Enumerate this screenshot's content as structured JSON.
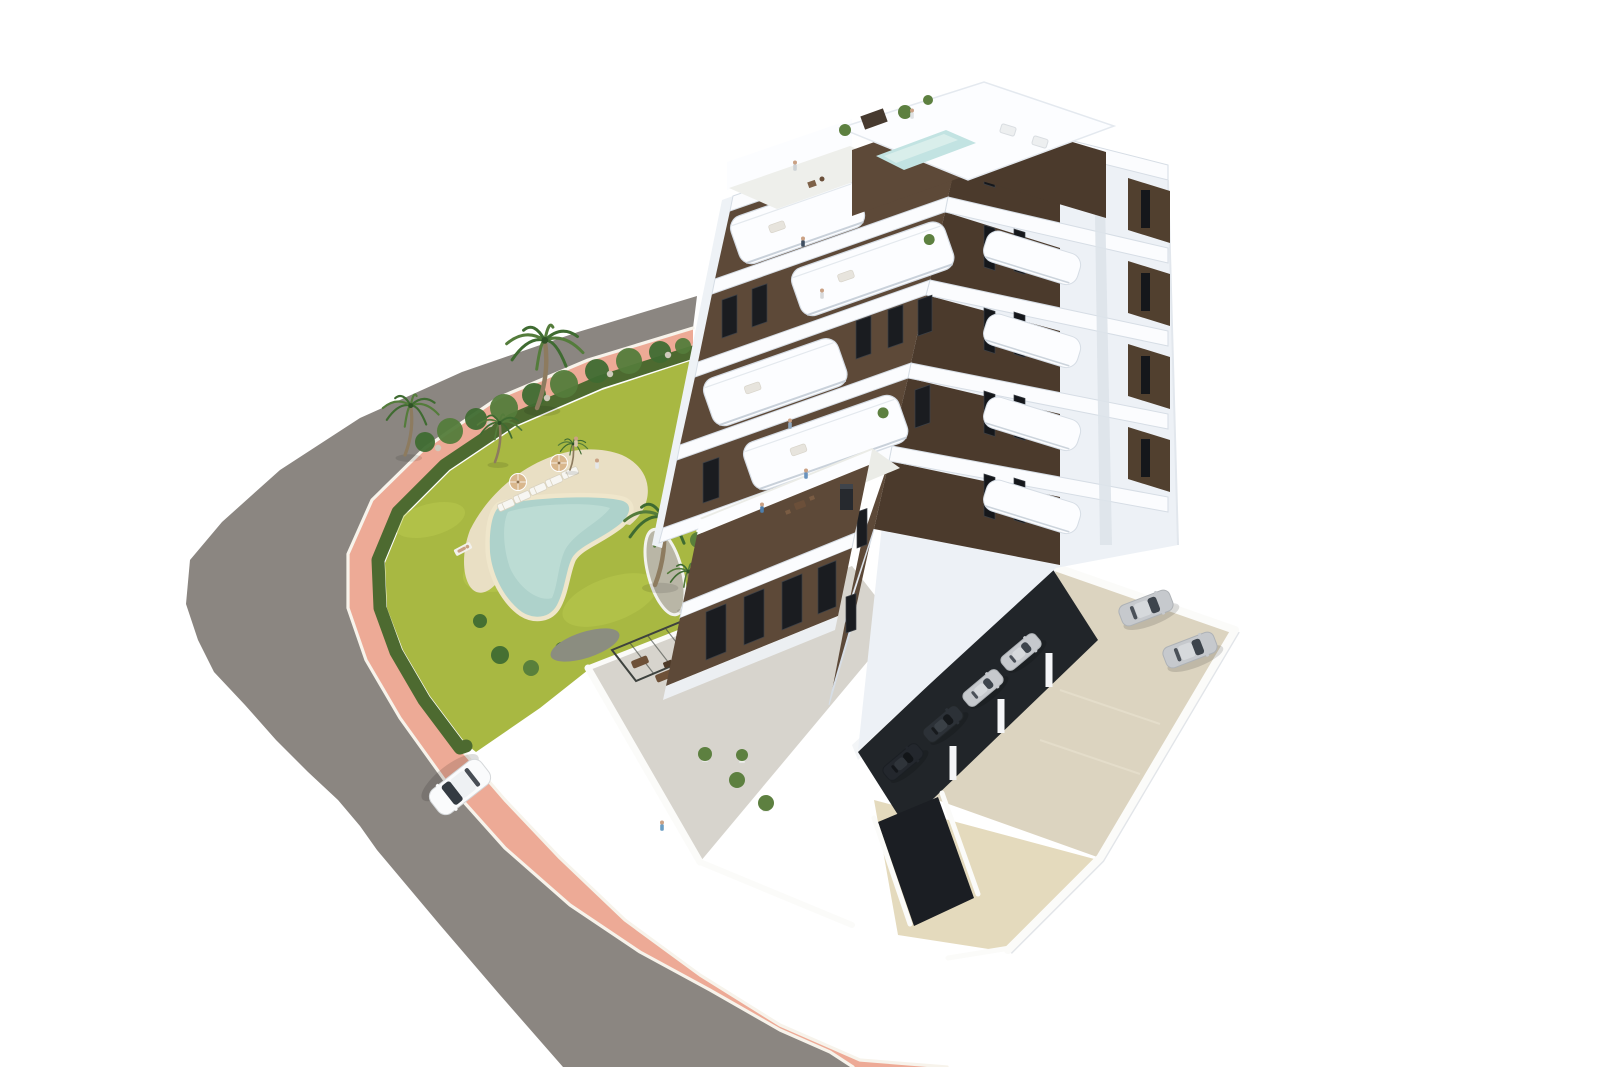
{
  "meta": {
    "title": "Aerial 3D architectural render - modern seaside apartment residence",
    "description": "Aerial 3D architectural rendering of a modern eight-storey white apartment tower with dark-brown facade panels, rounded white balconies, rooftop terraces with a small plunge pool, a landscaped garden with a free-form swimming pool, sun loungers, parasols and palm trees, a curved grey asphalt road with a salmon-pink promenade sidewalk, a white car driving on the road, and a walled parking area with parked cars.",
    "background": "#ffffff"
  },
  "colors": {
    "background": "#ffffff",
    "road": "#8b8681",
    "road_dark": "#7e7974",
    "sidewalk_pink": "#edaa96",
    "sidewalk_pink_light": "#f3bfae",
    "curb": "#f7f3eb",
    "hedge": "#4d6a30",
    "grass": "#a8b842",
    "grass_light": "#bac94e",
    "grass_shadow": "#8aa03a",
    "sand": "#e9dfc4",
    "pool_water": "#aed2cb",
    "pool_water_light": "#c9e3dc",
    "pool_coping": "#efe6cb",
    "building_white": "#fcfdff",
    "slab_white": "#fbfcfe",
    "slab_stroke": "#d6dde5",
    "face_shade": "#edf1f6",
    "face_shade_dark": "#dde3ea",
    "facade_brown": "#5d4938",
    "facade_brown_dark": "#4b3a2c",
    "window_dark": "#1a1c20",
    "terrace_concrete": "#d7d4cd",
    "parking_ground": "#dcd4c0",
    "driveway_beige": "#e4dabd",
    "garage_dark": "#212529",
    "wall_white": "#fbfbf9",
    "rooftop_pool": "#c2e3e2",
    "palm_green": "#3f6b31",
    "palm_green2": "#547c3b",
    "palm_trunk": "#8d7b5f",
    "plant_green": "#5d8040",
    "rock_gray": "#b9b6a6",
    "umbrella_tan": "#d9b78d",
    "car_white": "#fafbfc",
    "car_silver": "#c6c9cd",
    "car_dark": "#2c3137",
    "car_glass": "#343b42",
    "skin": "#caa184"
  },
  "counts": {
    "building_floors_visible": 8,
    "palm_trees": 6,
    "sun_loungers": 5,
    "parasols": 2,
    "people_visible": 11,
    "cars_on_road": 1,
    "cars_in_open_parking": 2,
    "cars_under_building": 4
  },
  "palms": [
    [
      405,
      455,
      0.95
    ],
    [
      537,
      408,
      1.3
    ],
    [
      495,
      462,
      0.75
    ],
    [
      570,
      470,
      0.5
    ],
    [
      655,
      585,
      1.3
    ],
    [
      684,
      608,
      0.7
    ]
  ],
  "bushes": [
    [
      425,
      442,
      10
    ],
    [
      450,
      431,
      13
    ],
    [
      476,
      419,
      11
    ],
    [
      504,
      408,
      14
    ],
    [
      534,
      395,
      12
    ],
    [
      564,
      384,
      14
    ],
    [
      597,
      371,
      12
    ],
    [
      629,
      361,
      13
    ],
    [
      660,
      352,
      11
    ],
    [
      683,
      346,
      8
    ],
    [
      500,
      655,
      9
    ],
    [
      531,
      668,
      8
    ],
    [
      562,
      649,
      7
    ],
    [
      601,
      641,
      8
    ],
    [
      480,
      621,
      7
    ],
    [
      700,
      470,
      8
    ],
    [
      706,
      502,
      7
    ],
    [
      698,
      540,
      8
    ]
  ],
  "rocks": [
    [
      438,
      448
    ],
    [
      490,
      424
    ],
    [
      547,
      398
    ],
    [
      610,
      374
    ],
    [
      668,
      355
    ],
    [
      672,
      590
    ],
    [
      690,
      602
    ],
    [
      660,
      600
    ],
    [
      600,
      648
    ],
    [
      575,
      640
    ]
  ],
  "grass_patches": [
    [
      520,
      560,
      60,
      26,
      -20
    ],
    [
      610,
      600,
      50,
      22,
      -20
    ],
    [
      430,
      520,
      36,
      16,
      -15
    ]
  ],
  "loungers": [
    [
      506,
      505,
      -24
    ],
    [
      522,
      497,
      -24
    ],
    [
      538,
      489,
      -24
    ],
    [
      554,
      481,
      -24
    ],
    [
      570,
      473,
      -24
    ]
  ],
  "umbrellas": [
    [
      518,
      482
    ],
    [
      559,
      463
    ]
  ],
  "sunbather": {
    "x": 463,
    "y": 549,
    "angle": -28
  },
  "people": [
    [
      597,
      468,
      "#e5e7e9"
    ],
    [
      576,
      446,
      "#d8c6ae"
    ],
    [
      762,
      512,
      "#4d7fae"
    ],
    [
      806,
      478,
      "#6a93bd"
    ],
    [
      790,
      428,
      "#8fa6bd"
    ],
    [
      803,
      246,
      "#3f4e60"
    ],
    [
      822,
      298,
      "#d8dadc"
    ],
    [
      795,
      170,
      "#cdd2d6"
    ],
    [
      912,
      118,
      "#dfe2e4"
    ],
    [
      662,
      830,
      "#6b9ec4"
    ]
  ],
  "sw_windows": [
    [
      872,
      168,
      15,
      36
    ],
    [
      904,
      157,
      15,
      36
    ],
    [
      934,
      146,
      14,
      34
    ],
    [
      722,
      300,
      15,
      38
    ],
    [
      752,
      289,
      15,
      38
    ],
    [
      856,
      321,
      15,
      38
    ],
    [
      888,
      310,
      15,
      38
    ],
    [
      918,
      300,
      14,
      36
    ],
    [
      703,
      463,
      16,
      40
    ],
    [
      915,
      390,
      15,
      38
    ],
    [
      868,
      172,
      14,
      30
    ],
    [
      898,
      161,
      14,
      30
    ],
    [
      927,
      151,
      13,
      28
    ],
    [
      857,
      512,
      10,
      36
    ],
    [
      846,
      597,
      10,
      36
    ],
    [
      830,
      487,
      14,
      36
    ]
  ],
  "wing_windows": [
    [
      706,
      612,
      20,
      48
    ],
    [
      744,
      597,
      20,
      48
    ],
    [
      782,
      582,
      20,
      48
    ],
    [
      818,
      568,
      18,
      46
    ]
  ],
  "se_windows": [
    [
      984,
      142,
      11,
      42
    ],
    [
      1014,
      146,
      11,
      42
    ],
    [
      984,
      225,
      11,
      42
    ],
    [
      1014,
      229,
      11,
      42
    ],
    [
      984,
      308,
      11,
      42
    ],
    [
      1014,
      312,
      11,
      42
    ],
    [
      984,
      391,
      11,
      42
    ],
    [
      1014,
      395,
      11,
      42
    ],
    [
      984,
      474,
      11,
      42
    ],
    [
      1014,
      478,
      11,
      42
    ],
    [
      985,
      138,
      12,
      30
    ],
    [
      1015,
      147,
      12,
      30
    ],
    [
      1046,
      156,
      12,
      30
    ]
  ],
  "pier_panels": [
    [
      1128,
      178
    ],
    [
      1128,
      261
    ],
    [
      1128,
      344
    ],
    [
      1128,
      427
    ]
  ],
  "sw_balconies": [
    {
      "x": 727,
      "y": 220,
      "w": 132,
      "h": 50,
      "a": -19.3,
      "plant": false
    },
    {
      "x": 788,
      "y": 272,
      "w": 162,
      "h": 50,
      "a": -19.3,
      "plant": true
    },
    {
      "x": 700,
      "y": 382,
      "w": 142,
      "h": 50,
      "a": -19.3,
      "plant": false
    },
    {
      "x": 740,
      "y": 446,
      "w": 164,
      "h": 50,
      "a": -19.3,
      "plant": true
    },
    {
      "x": 702,
      "y": 538,
      "w": 124,
      "h": 46,
      "a": -22.1,
      "plant": false
    }
  ],
  "se_balconies": [
    [
      990,
      228
    ],
    [
      990,
      311
    ],
    [
      990,
      394
    ],
    [
      990,
      477
    ]
  ],
  "cars": {
    "road_car": {
      "x": 460,
      "y": 787,
      "angle": 142,
      "type": "road",
      "color": "white"
    },
    "parking_cars": [
      {
        "x": 1146,
        "y": 608,
        "angle": -21,
        "type": "parking",
        "color": "silver"
      },
      {
        "x": 1190,
        "y": 650,
        "angle": -21,
        "type": "parking",
        "color": "silver"
      }
    ],
    "covered_cars": [
      {
        "x": 903,
        "y": 762,
        "angle": -40,
        "type": "covered",
        "color": "dark2"
      },
      {
        "x": 943,
        "y": 724,
        "angle": -40,
        "type": "covered",
        "color": "dark"
      },
      {
        "x": 983,
        "y": 688,
        "angle": -40,
        "type": "covered",
        "color": "silver"
      },
      {
        "x": 1021,
        "y": 652,
        "angle": -40,
        "type": "covered",
        "color": "silver"
      }
    ]
  }
}
